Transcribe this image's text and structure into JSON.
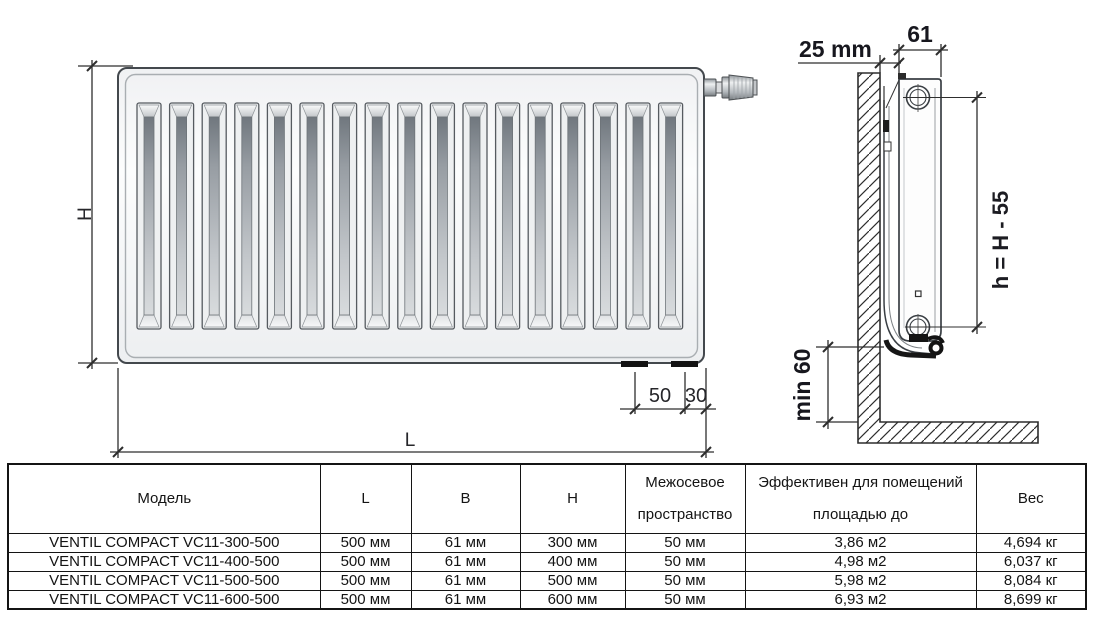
{
  "diagram": {
    "front": {
      "dim_height": "H",
      "dim_length": "L",
      "dim_50": "50",
      "dim_30": "30"
    },
    "side": {
      "dim_wall_gap": "25 mm",
      "dim_depth": "61",
      "dim_axis_formula": "h = H - 55",
      "dim_floor_clearance": "min 60"
    }
  },
  "table": {
    "headers": {
      "model": "Модель",
      "l": "L",
      "b": "B",
      "h": "H",
      "spacing1": "Межосевое",
      "spacing2": "пространство",
      "effective1": "Эффективен для помещений",
      "effective2": "площадью до",
      "weight": "Вес"
    },
    "rows": [
      {
        "model": "VENTIL COMPACT VC11-300-500",
        "l": "500 мм",
        "b": "61 мм",
        "h": "300 мм",
        "spacing": "50 мм",
        "effective": "3,86 м2",
        "weight": "4,694 кг"
      },
      {
        "model": "VENTIL COMPACT VC11-400-500",
        "l": "500 мм",
        "b": "61 мм",
        "h": "400 мм",
        "spacing": "50 мм",
        "effective": "4,98 м2",
        "weight": "6,037 кг"
      },
      {
        "model": "VENTIL COMPACT VC11-500-500",
        "l": "500 мм",
        "b": "61 мм",
        "h": "500 мм",
        "spacing": "50 мм",
        "effective": "5,98 м2",
        "weight": "8,084 кг"
      },
      {
        "model": "VENTIL COMPACT VC11-600-500",
        "l": "500 мм",
        "b": "61 мм",
        "h": "600 мм",
        "spacing": "50 мм",
        "effective": "6,93 м2",
        "weight": "8,699 кг"
      }
    ]
  }
}
